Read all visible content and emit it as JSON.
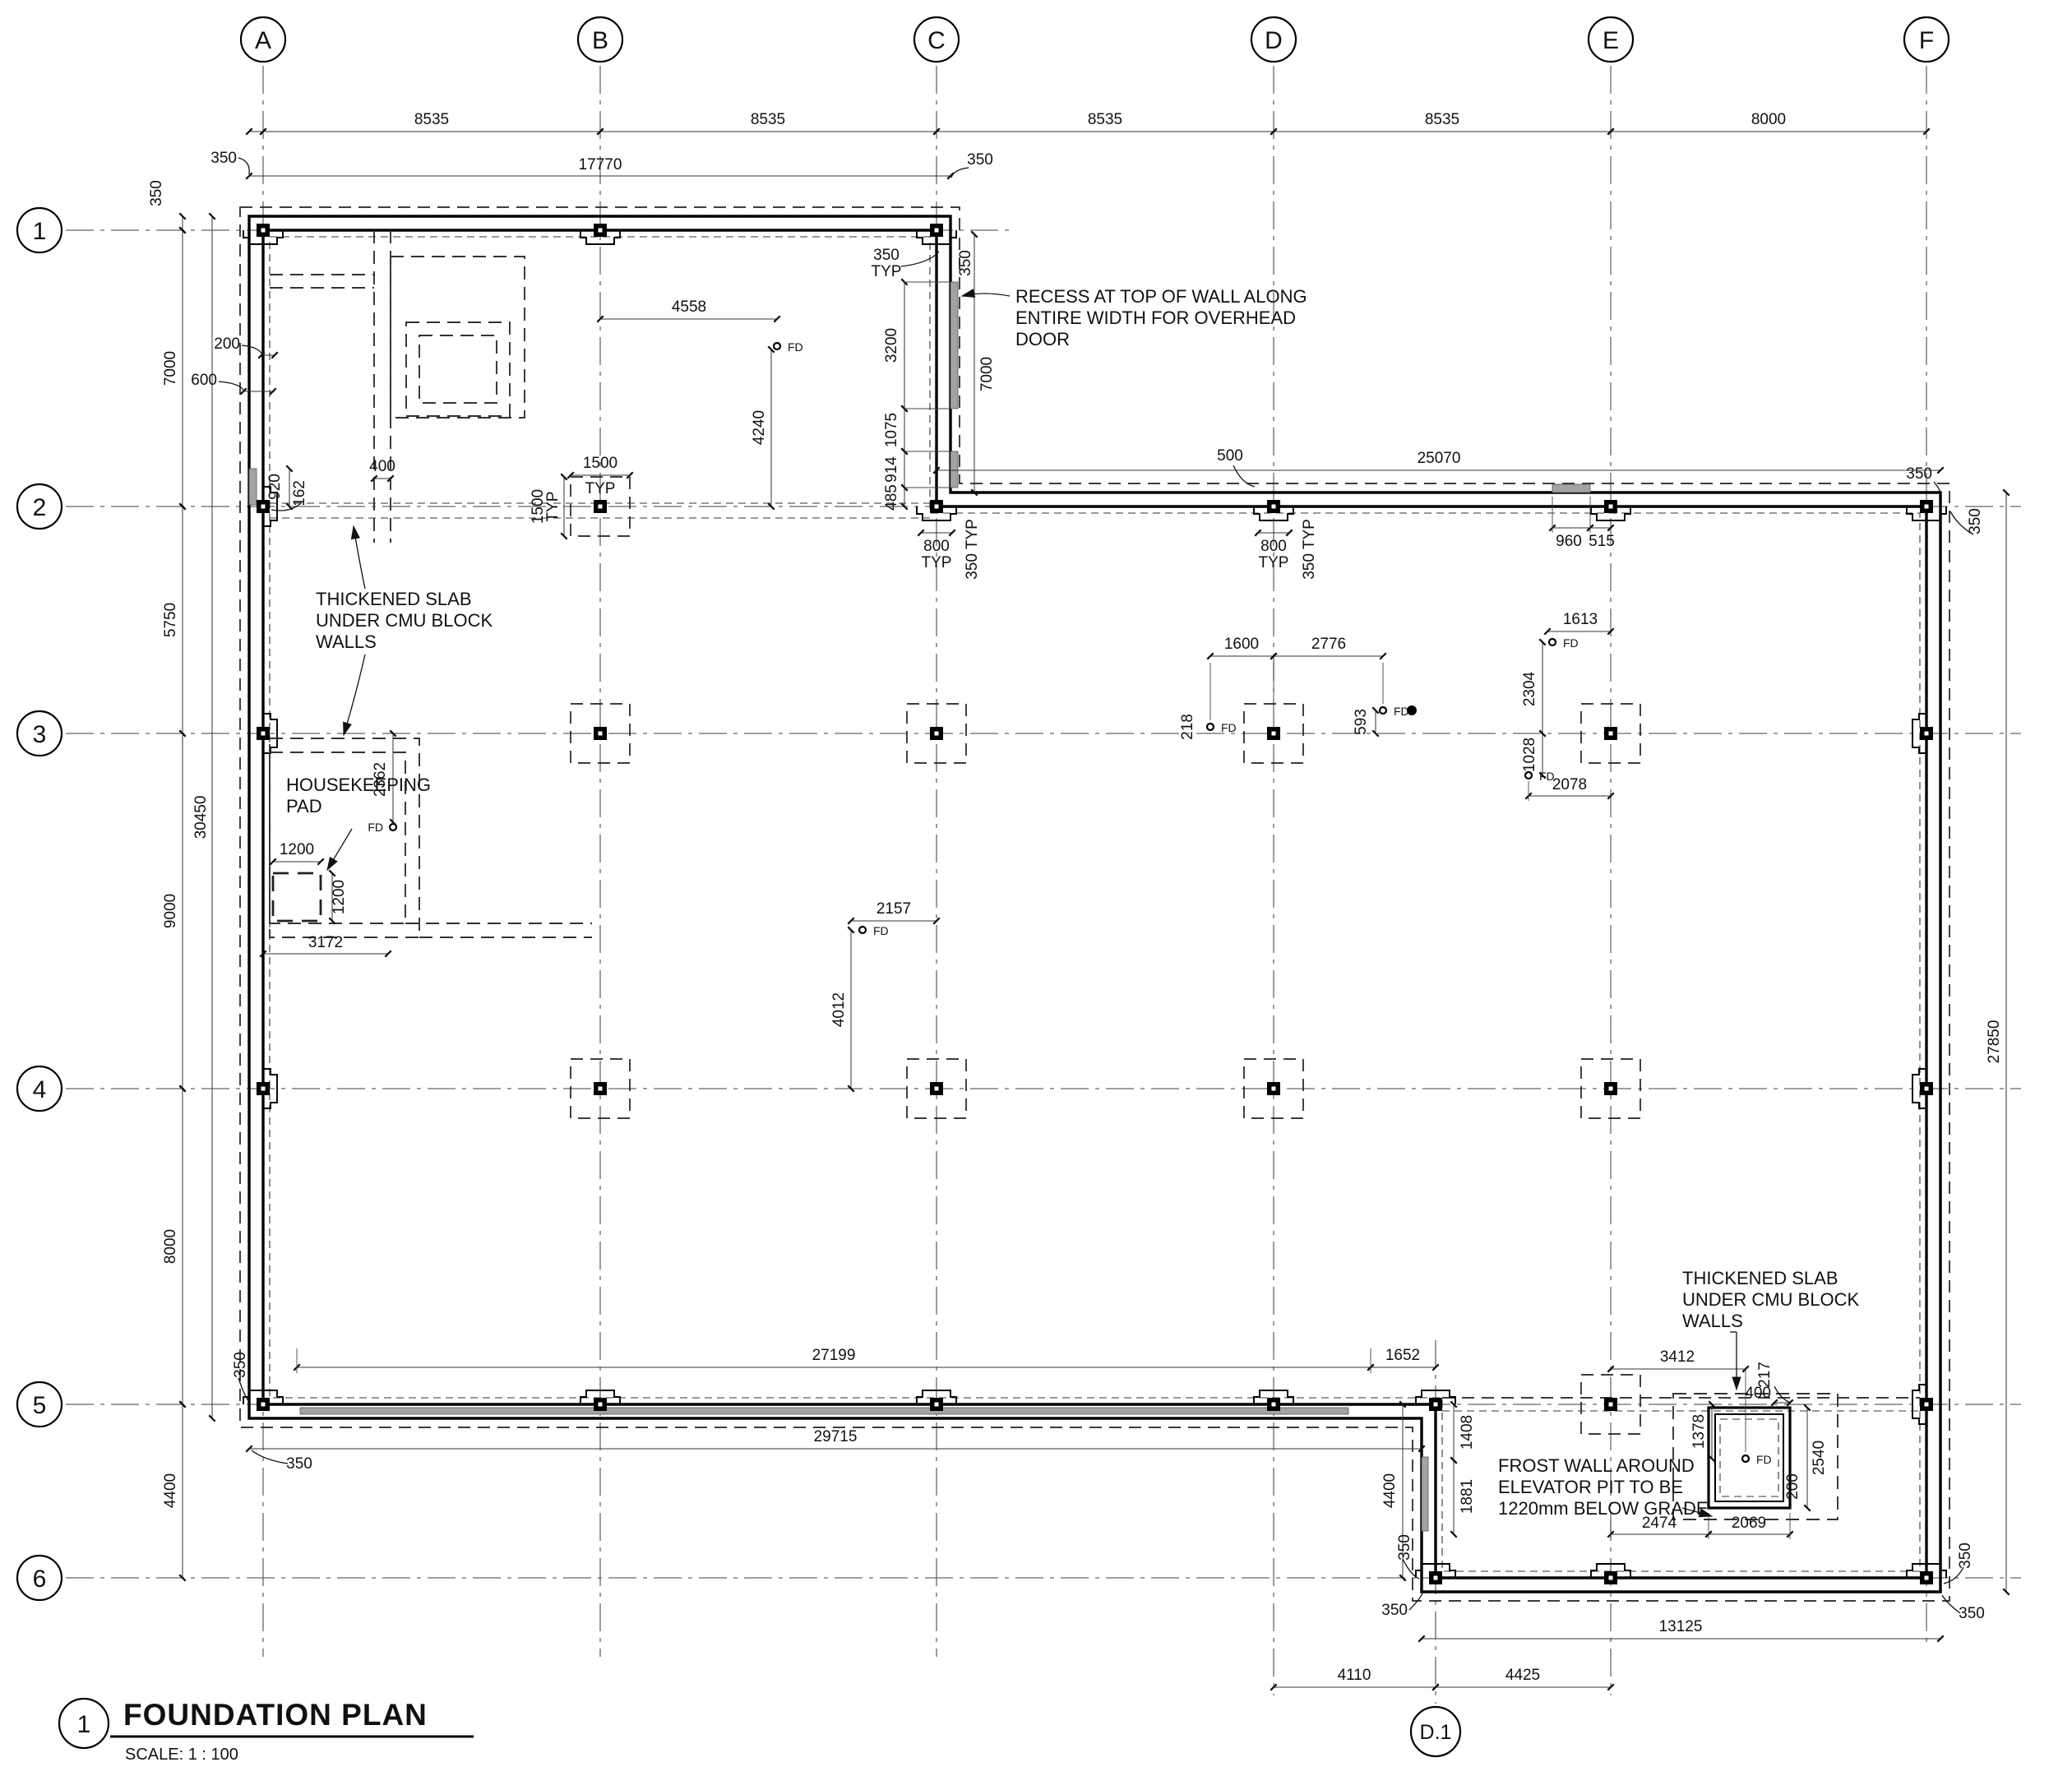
{
  "title": {
    "number": "1",
    "name": "FOUNDATION PLAN",
    "scale": "SCALE:  1 : 100"
  },
  "grid": {
    "cols": [
      "A",
      "B",
      "C",
      "D",
      "E",
      "F"
    ],
    "rows": [
      "1",
      "2",
      "3",
      "4",
      "5",
      "6"
    ],
    "col_d1": "D.1"
  },
  "labels": {
    "fd": "FD",
    "typ": "TYP",
    "typ350": "350 TYP"
  },
  "notes": {
    "recess": {
      "l1": "RECESS AT TOP OF WALL ALONG",
      "l2": "ENTIRE WIDTH FOR OVERHEAD",
      "l3": "DOOR"
    },
    "slab1": {
      "l1": "THICKENED SLAB",
      "l2": "UNDER CMU BLOCK",
      "l3": "WALLS"
    },
    "slab2": {
      "l1": "THICKENED SLAB",
      "l2": "UNDER CMU BLOCK",
      "l3": "WALLS"
    },
    "housekeeping": {
      "l1": "HOUSEKEEPING",
      "l2": "PAD"
    },
    "frost": {
      "l1": "FROST WALL AROUND",
      "l2": "ELEVATOR PIT TO BE",
      "l3": "1220mm BELOW GRADE"
    }
  },
  "dims": {
    "350": "350",
    "8535": "8535",
    "8000": "8000",
    "17770": "17770",
    "7000": "7000",
    "5750": "5750",
    "9000": "9000",
    "4400": "4400",
    "30450": "30450",
    "27850": "27850",
    "200": "200",
    "600": "600",
    "920": "920",
    "162": "162",
    "400": "400",
    "1500": "1500",
    "4558": "4558",
    "4240": "4240",
    "3200": "3200",
    "1075": "1075",
    "914": "914",
    "485": "485",
    "800": "800",
    "500": "500",
    "960": "960",
    "515": "515",
    "25070": "25070",
    "1600": "1600",
    "2776": "2776",
    "218": "218",
    "593": "593",
    "1613": "1613",
    "2304": "2304",
    "1028": "1028",
    "2078": "2078",
    "2157": "2157",
    "4012": "4012",
    "1200": "1200",
    "2362": "2362",
    "3172": "3172",
    "27199": "27199",
    "29715": "29715",
    "1652": "1652",
    "1408": "1408",
    "1881": "1881",
    "3412": "3412",
    "1378": "1378",
    "2540": "2540",
    "217": "217",
    "2474": "2474",
    "2069": "2069",
    "13125": "13125",
    "4110": "4110",
    "4425": "4425"
  }
}
